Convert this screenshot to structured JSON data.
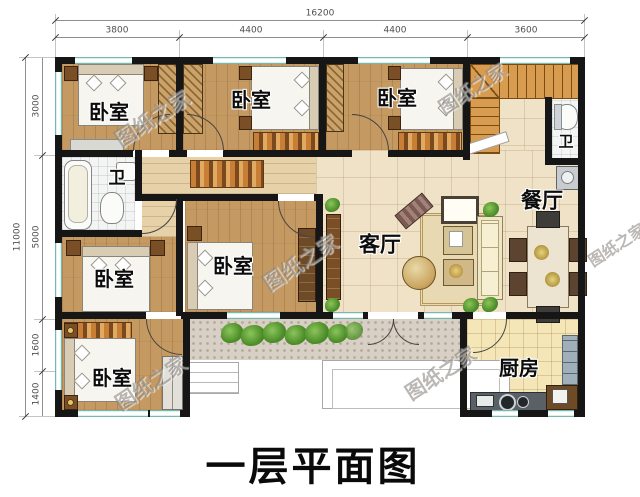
{
  "title": "一层平面图",
  "watermark_text": "图纸之家",
  "dimensions": {
    "top_total": "16200",
    "top_segments": [
      "3800",
      "4400",
      "4400",
      "3600"
    ],
    "left_total": "11000",
    "left_segments": [
      "3000",
      "5000",
      "1600",
      "1400"
    ]
  },
  "rooms": {
    "bedroom_top_left": {
      "label": "卧室"
    },
    "bedroom_top_middle": {
      "label": "卧室"
    },
    "bedroom_top_right": {
      "label": "卧室"
    },
    "bedroom_mid_left": {
      "label": "卧室"
    },
    "bedroom_mid_center": {
      "label": "卧室"
    },
    "bedroom_bottom_left": {
      "label": "卧室"
    },
    "bath_left": {
      "label": "卫"
    },
    "bath_stair": {
      "label": "卫"
    },
    "living_room": {
      "label": "客厅"
    },
    "dining_room": {
      "label": "餐厅"
    },
    "kitchen": {
      "label": "厨房"
    }
  },
  "colors": {
    "wall": "#161616",
    "window": "#a9d8d0",
    "bedroom_floor": "#c59a62",
    "hall_floor": "#e6d1a8",
    "living_floor": "#f0e2c6",
    "kitchen_floor": "#f5e6b8",
    "bath_floor": "#f3f5f5",
    "porch_floor": "#d8d0c4",
    "stair_wood": "#d89c50",
    "plant_green": "#4e8f2a",
    "rug_orange": "#c87f35"
  }
}
